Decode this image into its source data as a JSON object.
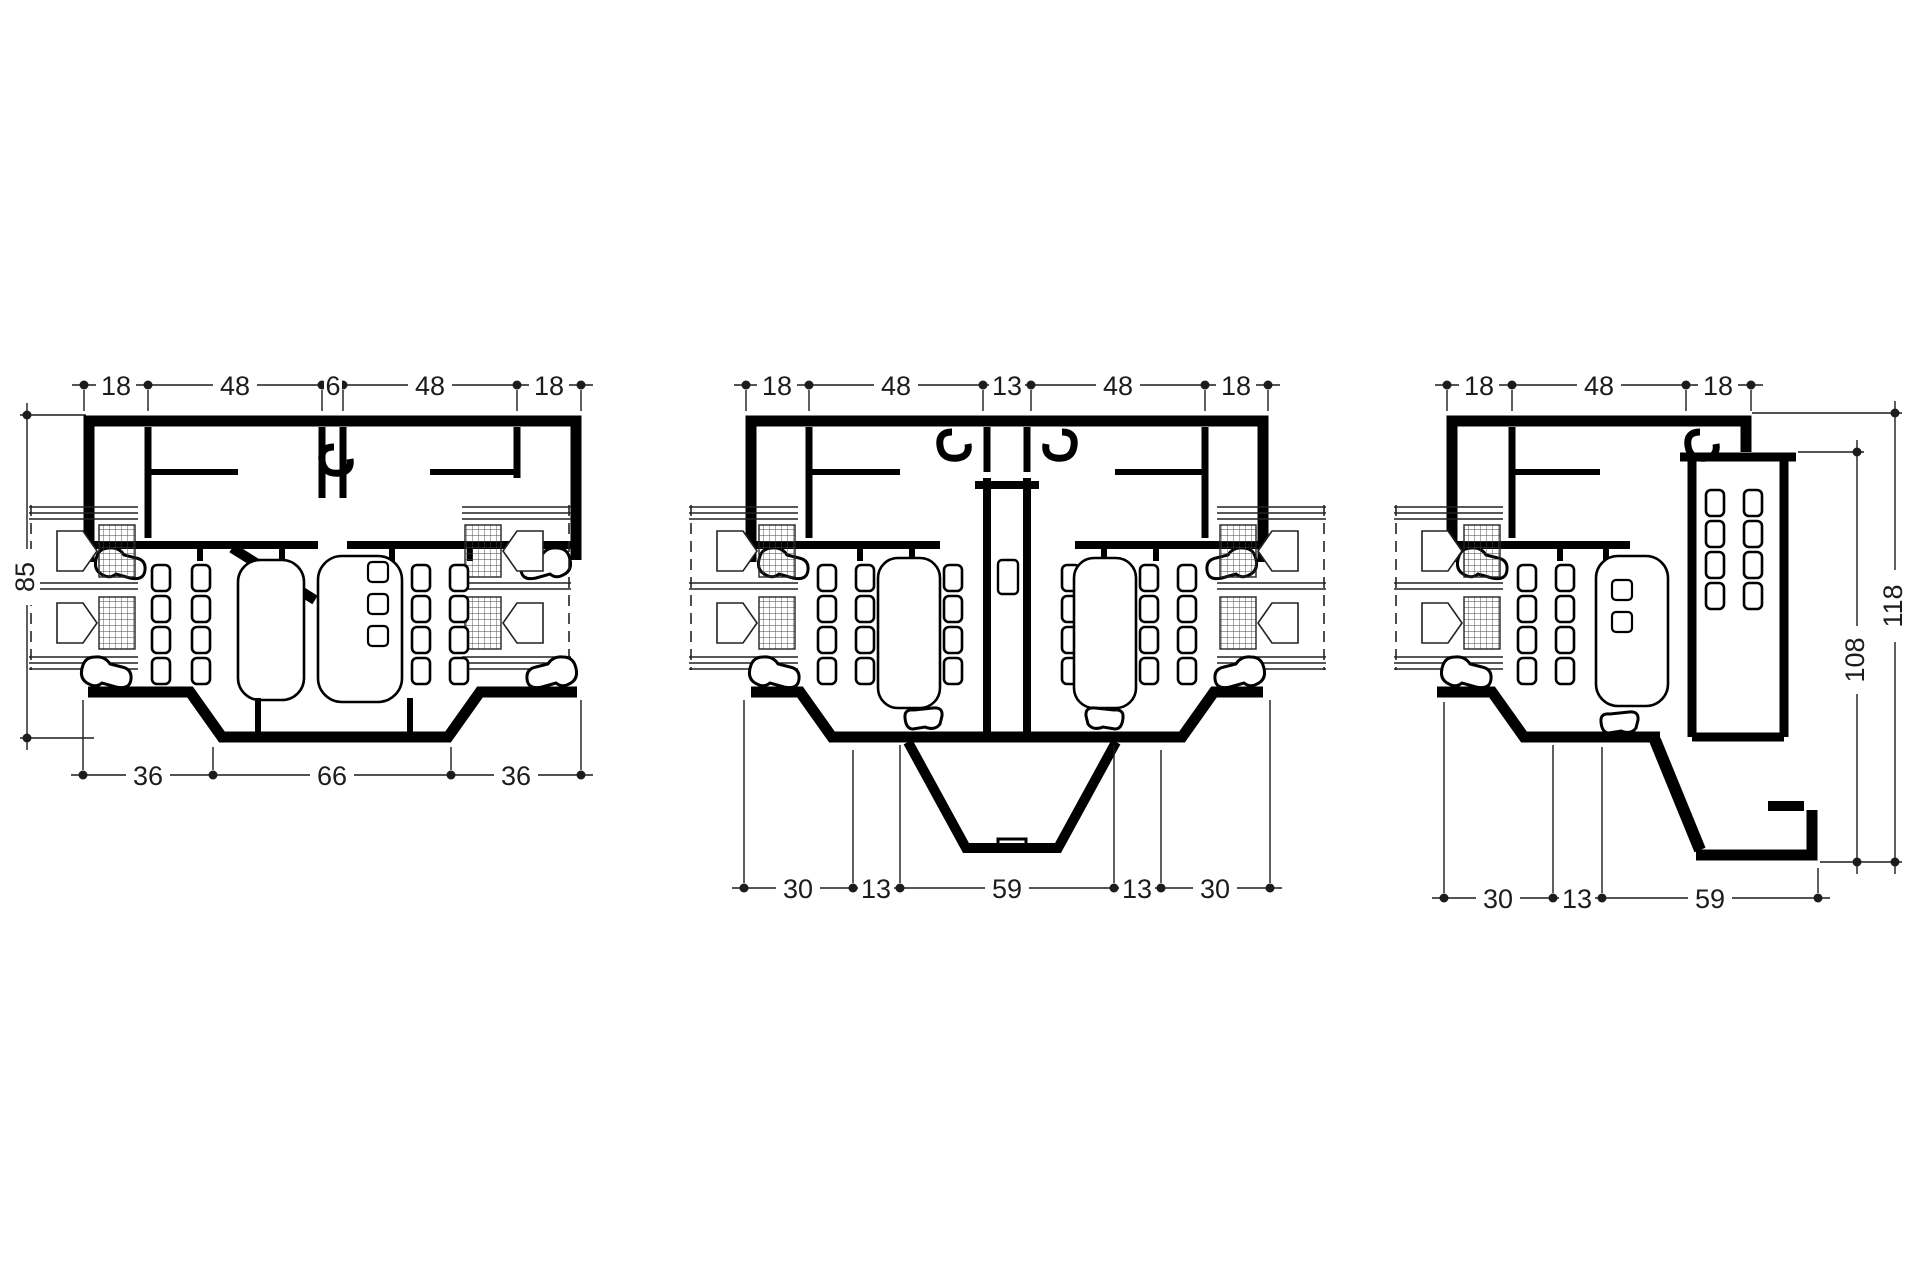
{
  "meta": {
    "sheet_type": "profile-cross-section-drawing",
    "background_color": "#ffffff",
    "profile_ink_color": "#000000",
    "dimension_color": "#1c1c1c"
  },
  "drawings": {
    "left": {
      "title": "section-left",
      "top_dims": [
        "18",
        "48",
        "6",
        "48",
        "18"
      ],
      "side_dims": [
        "85"
      ],
      "bottom_dims": [
        "36",
        "66",
        "36"
      ]
    },
    "middle": {
      "title": "section-middle",
      "top_dims": [
        "18",
        "48",
        "13",
        "48",
        "18"
      ],
      "bottom_dims": [
        "30",
        "13",
        "59",
        "13",
        "30"
      ]
    },
    "right": {
      "title": "section-right",
      "top_dims": [
        "18",
        "48",
        "18"
      ],
      "side_dims": [
        "108",
        "118"
      ],
      "bottom_dims": [
        "30",
        "13",
        "59"
      ]
    }
  }
}
